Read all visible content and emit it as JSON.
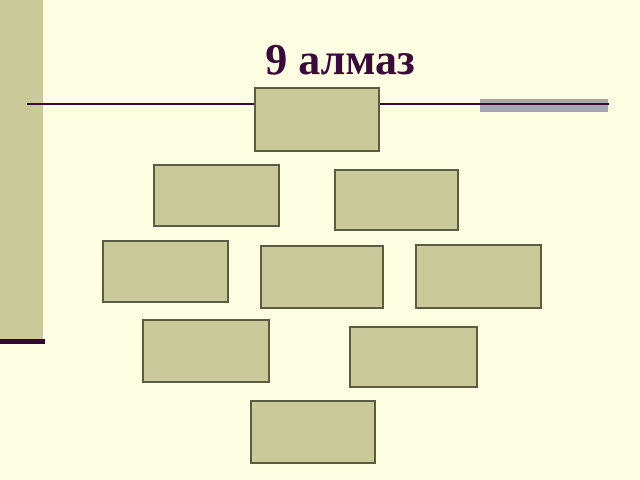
{
  "slide": {
    "title": "9 алмаз",
    "layout_name": "diamond-9",
    "box_count": 9,
    "colors": {
      "background": "#FDFEE2",
      "title": "#3A0A3A",
      "rule": "#3A0A3A",
      "gray_bar": "#A7A7B4",
      "sidebar": "#C9C99A",
      "sidebar_accent": "#2F0730",
      "box_fill": "#C9C99A",
      "box_border": "#5C5C44"
    },
    "boxes": [
      {
        "id": "box-1",
        "row": 1,
        "label": "",
        "x": 254,
        "y": 87,
        "w": 126,
        "h": 65
      },
      {
        "id": "box-2",
        "row": 2,
        "label": "",
        "x": 153,
        "y": 164,
        "w": 127,
        "h": 63
      },
      {
        "id": "box-3",
        "row": 2,
        "label": "",
        "x": 334,
        "y": 169,
        "w": 125,
        "h": 62
      },
      {
        "id": "box-4",
        "row": 3,
        "label": "",
        "x": 102,
        "y": 240,
        "w": 127,
        "h": 63
      },
      {
        "id": "box-5",
        "row": 3,
        "label": "",
        "x": 260,
        "y": 245,
        "w": 124,
        "h": 64
      },
      {
        "id": "box-6",
        "row": 3,
        "label": "",
        "x": 415,
        "y": 244,
        "w": 127,
        "h": 65
      },
      {
        "id": "box-7",
        "row": 4,
        "label": "",
        "x": 142,
        "y": 319,
        "w": 128,
        "h": 64
      },
      {
        "id": "box-8",
        "row": 4,
        "label": "",
        "x": 349,
        "y": 326,
        "w": 129,
        "h": 62
      },
      {
        "id": "box-9",
        "row": 5,
        "label": "",
        "x": 250,
        "y": 400,
        "w": 126,
        "h": 64
      }
    ]
  }
}
